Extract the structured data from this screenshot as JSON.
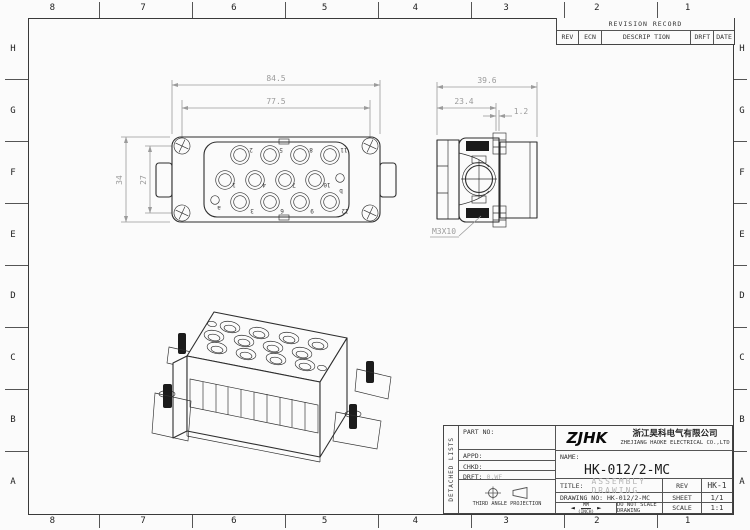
{
  "frame": {
    "column_labels": [
      "8",
      "7",
      "6",
      "5",
      "4",
      "3",
      "2",
      "1"
    ],
    "row_labels": [
      "H",
      "G",
      "F",
      "E",
      "D",
      "C",
      "B",
      "A"
    ]
  },
  "revision_table": {
    "title": "REVISION RECORD",
    "headers": [
      "REV",
      "ECN",
      "DESCRIP TION",
      "DRFT",
      "DATE"
    ]
  },
  "front_view": {
    "dim_overall_width": "84.5",
    "dim_screw_span": "77.5",
    "dim_overall_height": "34",
    "dim_screw_height": "27",
    "pins": [
      "1",
      "2",
      "3",
      "4",
      "5",
      "6",
      "7",
      "8",
      "9",
      "10",
      "11",
      "12"
    ],
    "aux_pins": [
      "a",
      "b"
    ]
  },
  "side_view": {
    "dim_overall_depth": "39.6",
    "dim_body_depth": "23.4",
    "dim_flange": "1.2",
    "thread_callout": "M3X10"
  },
  "title_block": {
    "side_label": "DETACHED LISTS",
    "part_no_label": "PART NO:",
    "appd_label": "APPD:",
    "chkd_label": "CHKD:",
    "drft_label": "DRFT:",
    "drft_value": "0.WF",
    "projection_label": "THIRD ANGLE PROJECTION",
    "logo": "ZJHK",
    "company_cn": "浙江昊科电气有限公司",
    "company_en": "ZHEJIANG HAOKE ELECTRICAL CO.,LTD",
    "name_label": "NAME:",
    "name_value": "HK-012/2-MC",
    "title_label": "TITLE:",
    "title_value": "ASSEMBLY DRAWING",
    "rev_label": "REV",
    "rev_value": "HK-1",
    "drawing_no_label": "DRAWING NO:",
    "drawing_no_value": "HK-012/2-MC",
    "sheet_label": "SHEET",
    "sheet_value": "1/1",
    "units_top": "MM",
    "units_bottom": "(INCH)",
    "scale_note": "DO NOT SCALE DRAWING",
    "scale_label": "SCALE",
    "scale_value": "1:1"
  },
  "colors": {
    "background": "#fbfbfb",
    "line": "#2e2e2e",
    "dimension": "#9b9b9b",
    "muted_text": "#b0b0b0"
  }
}
